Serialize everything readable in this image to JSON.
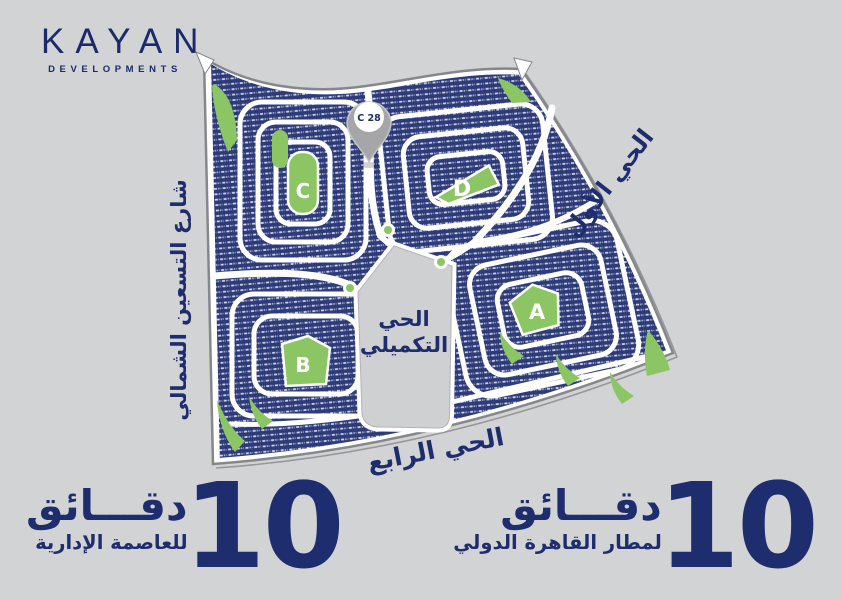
{
  "colors": {
    "background": "#d2d3d5",
    "plot_navy": "#2d3b7a",
    "park_green": "#8cc563",
    "road_white": "#ffffff",
    "text_navy": "#1e2d6e",
    "pin_gray": "#a6a6a8",
    "district_gray": "#cfd0d2"
  },
  "logo": {
    "name": "KAYAN",
    "tagline": "DEVELOPMENTS"
  },
  "map": {
    "pin": {
      "label": "C 28"
    },
    "parks": [
      {
        "letter": "A"
      },
      {
        "letter": "B"
      },
      {
        "letter": "C"
      },
      {
        "letter": "D"
      }
    ],
    "labels": {
      "first_district": "الحي الأول",
      "north_ninety_street": "شارع التسعين الشمالي",
      "complementary_line1": "الحي",
      "complementary_line2": "التكميلي",
      "fourth_district": "الحي الرابع"
    }
  },
  "badges": {
    "left": {
      "number": "10",
      "unit": "دقـــائق",
      "destination": "للعاصمة الإدارية"
    },
    "right": {
      "number": "10",
      "unit": "دقـــائق",
      "destination": "لمطار القاهرة الدولي"
    }
  }
}
